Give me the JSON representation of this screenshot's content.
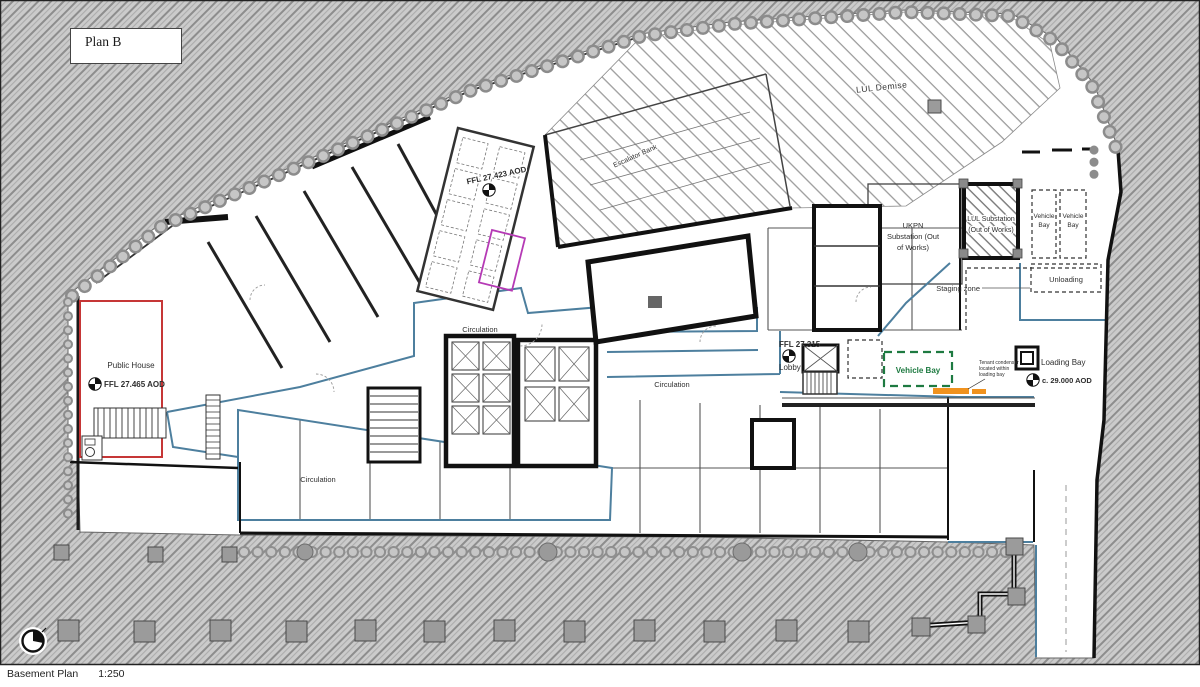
{
  "sheet": {
    "plan_label": "Plan B",
    "caption_title": "Basement Plan",
    "caption_scale": "1:250"
  },
  "labels": {
    "public_house": "Public House",
    "public_house_level": "FFL 27.465 AOD",
    "core_level": "FFL 27.423 AOD",
    "lul_demise": "LUL Demise",
    "escalator": "Escalator Bank",
    "ukpn_line1": "UKPN",
    "ukpn_line2": "Substation (Out",
    "ukpn_line3": "of Works)",
    "lul_substation_line1": "LUL Substation",
    "lul_substation_line2": "(Out of Works)",
    "vehicle_bay_line1": "Vehicle",
    "vehicle_bay_line2": "Bay",
    "unloading": "Unloading",
    "staging_zone": "Staging zone",
    "lobby_level": "FFL 27.315",
    "lobby": "Lobby",
    "vehicle_bay_green": "Vehicle Bay",
    "tenant_note_line1": "Tenant condenser",
    "tenant_note_line2": "located within",
    "tenant_note_line3": "loading bay",
    "loading_bay": "Loading Bay",
    "loading_bay_level": "c. 29.000 AOD",
    "circulation": "Circulation"
  },
  "colors": {
    "site_hatch_base": "#cbcbcb",
    "site_hatch_line": "#8d8d8d",
    "public_house_outline_red": "#c63636",
    "tenancy_magenta": "#b53ab5",
    "vehicle_bay_green": "#1e7a41",
    "condenser_orange": "#f0921e",
    "circulation_blue": "#4d7f9e"
  }
}
